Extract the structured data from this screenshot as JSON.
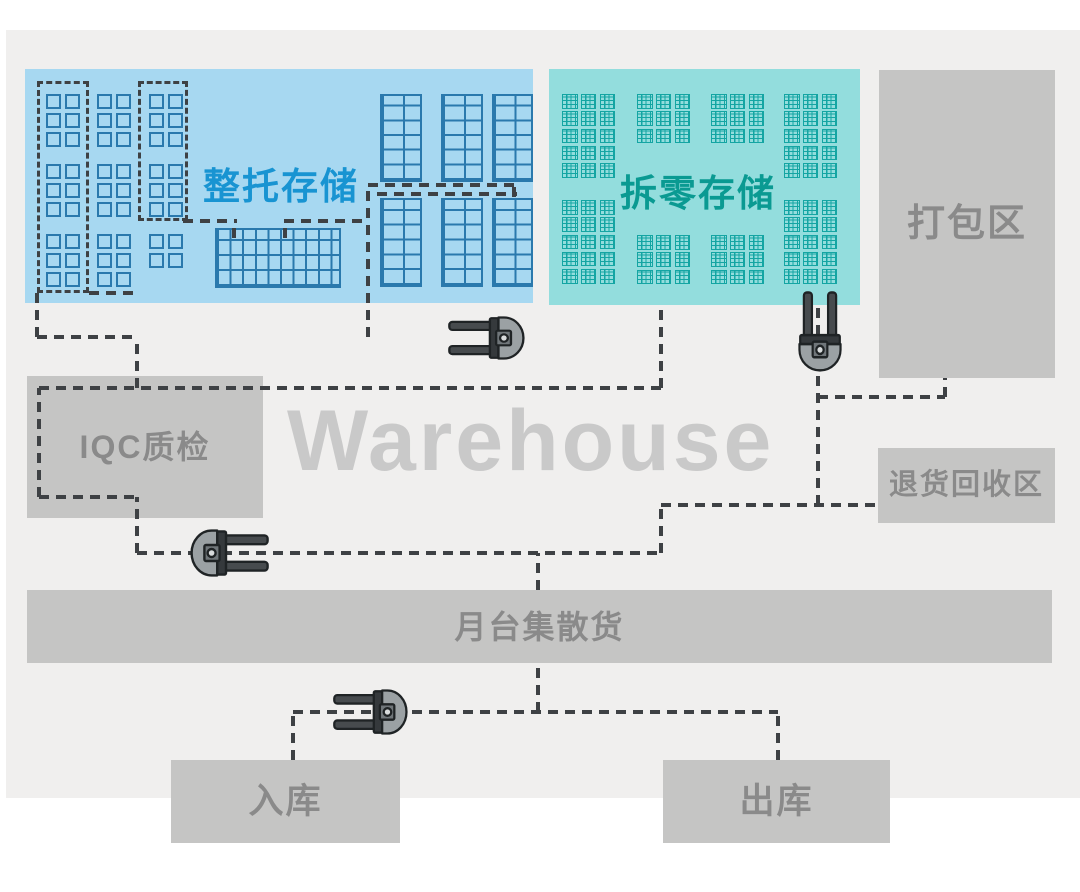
{
  "watermark": "Warehouse",
  "areas": {
    "full_pallet_storage": {
      "label": "整托存储",
      "fill": "#a7d8f1",
      "label_color": "#1894d2"
    },
    "broken_case_storage": {
      "label": "拆零存储",
      "fill": "#93dddd",
      "label_color": "#0a9a92"
    },
    "packing": {
      "label": "打包区",
      "fill": "#c5c5c4",
      "label_color": "#8a8a8a"
    },
    "iqc": {
      "label": "IQC质检",
      "fill": "#c5c5c4",
      "label_color": "#8a8a8a"
    },
    "returns": {
      "label": "退货回收区",
      "fill": "#c5c5c4",
      "label_color": "#8a8a8a"
    },
    "dock": {
      "label": "月台集散货",
      "fill": "#c5c5c4",
      "label_color": "#8a8a8a"
    },
    "inbound": {
      "label": "入库",
      "fill": "#c5c5c4",
      "label_color": "#8a8a8a"
    },
    "outbound": {
      "label": "出库",
      "fill": "#c5c5c4",
      "label_color": "#8a8a8a"
    }
  },
  "colors": {
    "page_bg": "#ffffff",
    "floor_bg": "#f0efee",
    "dash": "#3e4144",
    "blue_rack": "#2a79ad",
    "teal_rack": "#14a5a3",
    "watermark": "#c9c9c9"
  },
  "icons": {
    "forklift": "forklift-icon"
  },
  "diagram": {
    "pallet_groups": [
      {
        "x": 46,
        "y": 94,
        "rows": 3
      },
      {
        "x": 46,
        "y": 164,
        "rows": 3
      },
      {
        "x": 46,
        "y": 234,
        "rows": 3
      },
      {
        "x": 97,
        "y": 94,
        "rows": 3
      },
      {
        "x": 97,
        "y": 164,
        "rows": 3
      },
      {
        "x": 97,
        "y": 234,
        "rows": 3
      },
      {
        "x": 149,
        "y": 94,
        "rows": 3
      },
      {
        "x": 149,
        "y": 164,
        "rows": 3
      },
      {
        "x": 149,
        "y": 234,
        "rows": 2
      }
    ],
    "grids": [
      {
        "x": 215,
        "y": 228,
        "w": 126,
        "h": 60,
        "cx": 12.6,
        "cy": 15
      },
      {
        "x": 380,
        "y": 94,
        "w": 42,
        "h": 88,
        "cx": 21,
        "cy": 14.67
      },
      {
        "x": 441,
        "y": 94,
        "w": 42,
        "h": 88,
        "cx": 21,
        "cy": 14.67
      },
      {
        "x": 492,
        "y": 94,
        "w": 41,
        "h": 88,
        "cx": 20.5,
        "cy": 14.67
      },
      {
        "x": 380,
        "y": 198,
        "w": 42,
        "h": 89,
        "cx": 21,
        "cy": 14.83
      },
      {
        "x": 441,
        "y": 198,
        "w": 42,
        "h": 89,
        "cx": 21,
        "cy": 14.83
      },
      {
        "x": 492,
        "y": 198,
        "w": 41,
        "h": 89,
        "cx": 20.5,
        "cy": 14.83
      }
    ],
    "teal_groups": [
      {
        "x": 562,
        "y": 94,
        "cols": 3,
        "rows": 5
      },
      {
        "x": 637,
        "y": 94,
        "cols": 3,
        "rows": 3
      },
      {
        "x": 711,
        "y": 94,
        "cols": 3,
        "rows": 3
      },
      {
        "x": 784,
        "y": 94,
        "cols": 3,
        "rows": 5
      },
      {
        "x": 562,
        "y": 200,
        "cols": 3,
        "rows": 5
      },
      {
        "x": 637,
        "y": 235,
        "cols": 3,
        "rows": 3
      },
      {
        "x": 711,
        "y": 235,
        "cols": 3,
        "rows": 3
      },
      {
        "x": 784,
        "y": 200,
        "cols": 3,
        "rows": 5
      }
    ],
    "dash_rects": [
      {
        "x": 37,
        "y": 81,
        "w": 52,
        "h": 212
      },
      {
        "x": 138,
        "y": 81,
        "w": 50,
        "h": 140
      }
    ],
    "dash_segments": [
      {
        "o": "v",
        "x": 37,
        "y": 293,
        "l": 44
      },
      {
        "o": "h",
        "x": 37,
        "y": 337,
        "l": 102
      },
      {
        "o": "v",
        "x": 137,
        "y": 337,
        "l": 51
      },
      {
        "o": "h",
        "x": 39,
        "y": 388,
        "l": 622
      },
      {
        "o": "v",
        "x": 39,
        "y": 388,
        "l": 109
      },
      {
        "o": "h",
        "x": 39,
        "y": 497,
        "l": 100
      },
      {
        "o": "v",
        "x": 137,
        "y": 497,
        "l": 56
      },
      {
        "o": "h",
        "x": 137,
        "y": 553,
        "l": 524
      },
      {
        "o": "v",
        "x": 661,
        "y": 505,
        "l": 48
      },
      {
        "o": "h",
        "x": 661,
        "y": 505,
        "l": 217
      },
      {
        "o": "v",
        "x": 818,
        "y": 303,
        "l": 202
      },
      {
        "o": "h",
        "x": 818,
        "y": 397,
        "l": 127
      },
      {
        "o": "v",
        "x": 945,
        "y": 378,
        "l": 19
      },
      {
        "o": "v",
        "x": 538,
        "y": 553,
        "l": 37
      },
      {
        "o": "v",
        "x": 538,
        "y": 663,
        "l": 49
      },
      {
        "o": "h",
        "x": 293,
        "y": 712,
        "l": 485
      },
      {
        "o": "v",
        "x": 293,
        "y": 712,
        "l": 48
      },
      {
        "o": "v",
        "x": 778,
        "y": 712,
        "l": 48
      },
      {
        "o": "v",
        "x": 368,
        "y": 185,
        "l": 152
      },
      {
        "o": "h",
        "x": 368,
        "y": 185,
        "l": 149
      },
      {
        "o": "h",
        "x": 377,
        "y": 194,
        "l": 140
      },
      {
        "o": "v",
        "x": 514,
        "y": 185,
        "l": 12
      },
      {
        "o": "v",
        "x": 661,
        "y": 305,
        "l": 83
      },
      {
        "o": "h",
        "x": 183,
        "y": 221,
        "l": 54
      },
      {
        "o": "v",
        "x": 234,
        "y": 221,
        "l": 17
      },
      {
        "o": "h",
        "x": 284,
        "y": 221,
        "l": 84
      },
      {
        "o": "v",
        "x": 285,
        "y": 221,
        "l": 17
      },
      {
        "o": "h",
        "x": 89,
        "y": 293,
        "l": 49
      }
    ],
    "forklifts": [
      {
        "dir": "left",
        "cx": 486,
        "cy": 338,
        "w": 78,
        "h": 44
      },
      {
        "dir": "up",
        "cx": 820,
        "cy": 331,
        "w": 44,
        "h": 82
      },
      {
        "dir": "right",
        "cx": 230,
        "cy": 553,
        "w": 80,
        "h": 48
      },
      {
        "dir": "left",
        "cx": 370,
        "cy": 712,
        "w": 76,
        "h": 46
      }
    ]
  }
}
